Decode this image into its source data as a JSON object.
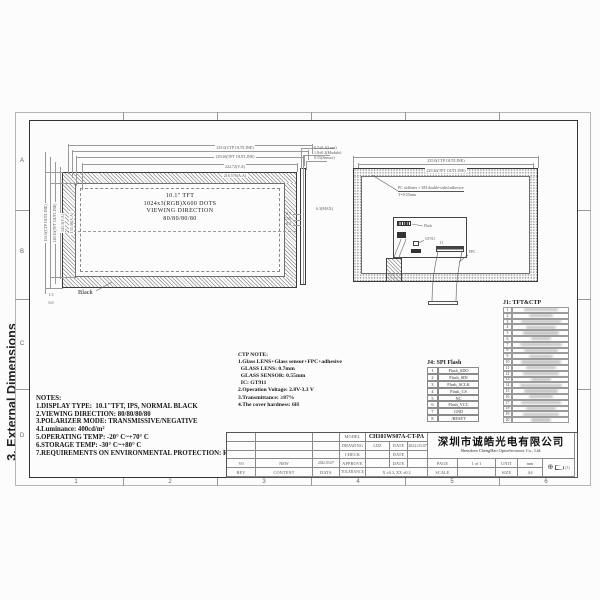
{
  "sheet": {
    "side_title": "3. External Dimensions",
    "grid_rows": [
      "A",
      "B",
      "C",
      "D"
    ],
    "grid_cols": [
      "1",
      "2",
      "3",
      "4",
      "5",
      "6"
    ]
  },
  "front_view": {
    "label_lines": [
      "10.1\" TFT",
      "1024x3(RGB)X600 DOTS",
      "VIEWING DIRECTION",
      "80/80/80/80"
    ],
    "black_label": "Black",
    "dims_top": [
      "235.0(CTP OUTLINE)",
      "229.46(TFT OUTLINE)",
      "222.72(V.A)",
      "216.576(A.A)"
    ],
    "dims_left": [
      "155.0(CTP OUTLINE)",
      "149.10(TFT OUTLINE)",
      "141.3(V.A)",
      "135.36(A.A)"
    ],
    "dims_corner": [
      "1.5",
      "6.0"
    ]
  },
  "side_view": {
    "dims_top": [
      "0.7±0.1(Lens)",
      "1.8±0.2(Module)",
      "0.55(Sensor)"
    ],
    "dims_left": [
      "0.7",
      "0.55",
      "0.2"
    ],
    "dim_mid": "6.3(MAX)"
  },
  "back_view": {
    "note_line1": "PC stiffener + 3M double-sided adhesive",
    "note_line2": "T=0.55mm",
    "dims_top": [
      "235.0(CTP OUTLINE)",
      "229.46(TFT OUTLINE)"
    ],
    "label_flash": "Flash",
    "label_ctp_ic": "GT911",
    "label_j1": "J1",
    "label_fpc": "FPC"
  },
  "notes": {
    "title": "NOTES:",
    "lines": [
      "1.DISPLAY TYPE:  10.1\"TFT, IPS, NORMAL BLACK",
      "2.VIEWING DIRECTION: 80/80/80/80",
      "3.POLARIZER MODE: TRANSMISSIVE/NEGATIVE",
      "4.Luminance: 400cd/m²",
      "5.OPERATING TEMP: -20° C~+70° C",
      "6.STORAGE TEMP: -30° C~+80° C",
      "7.REQUIREMENTS ON ENVIRONMENTAL PROTECTION: RoHS"
    ]
  },
  "ctp_note": {
    "title": "CTP NOTE:",
    "lines": [
      "1.Glass LENS+Glass sensor+FPC+adhesive",
      "  GLASS LENS: 0.7mm",
      "  GLASS SENSOR: 0.55mm",
      "  IC: GT911",
      "2.Operation Voltage: 2.8V-3.3 V",
      "3.Transmittance: ≥87%",
      "4.The cover hardness: 6H"
    ]
  },
  "tables": {
    "j1": {
      "title": "J1: TFT&CTP",
      "pins": [
        "1",
        "2",
        "3",
        "4",
        "5",
        "6",
        "7",
        "8",
        "9",
        "10",
        "11",
        "12",
        "13",
        "14",
        "15",
        "16",
        "17",
        "18",
        "19",
        "20"
      ]
    },
    "j4": {
      "title": "J4: SPI Flash",
      "rows": [
        [
          "1",
          "Flash_SDO"
        ],
        [
          "2",
          "Flash_SDI"
        ],
        [
          "3",
          "Flash_SCLK"
        ],
        [
          "4",
          "Flash_CS"
        ],
        [
          "5",
          "NC"
        ],
        [
          "6",
          "Flash_VCC"
        ],
        [
          "7",
          "GND"
        ],
        [
          "8",
          "/RESET"
        ]
      ]
    }
  },
  "title_block": {
    "labels": {
      "model": "MODEL",
      "drawing": "DRAWING",
      "check": "CHECK",
      "approve": "APPROVE",
      "date": "DATE",
      "rev": "REV",
      "content": "CONTENT",
      "data": "DATA",
      "tolerance": "TOLERANCE",
      "page": "PAGE",
      "unit": "UNIT",
      "scale": "SCALE",
      "size": "SIZE"
    },
    "model": "CH101WS07A-CT-PA",
    "drawing_by": "LDZ",
    "drawing_date": "2022.03.07",
    "revision": {
      "rev": "V0",
      "content": "NEW",
      "date": "2022.03.07"
    },
    "tolerance": "X ±0.3, XX ±0.2",
    "company_cn": "深圳市诚皓光电有限公司",
    "company_en": "Shenzhen ChengHao Optoelectronic Co., Ltd.",
    "page": "1 of 1",
    "unit": "mm",
    "scale": "",
    "size": "A4",
    "projection_note": "(3)"
  }
}
